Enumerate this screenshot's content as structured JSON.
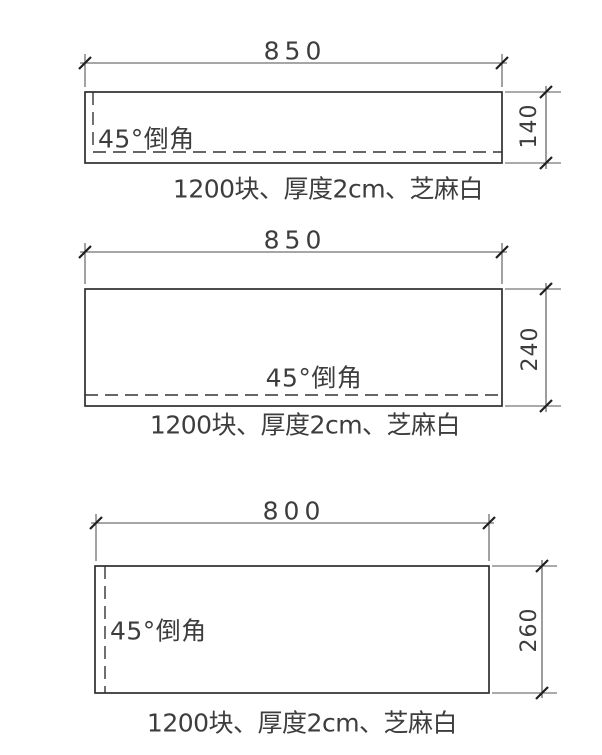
{
  "drawing": {
    "background_color": "#ffffff",
    "object_line_color": "#2e2e2e",
    "dimension_line_color": "#4d4d4d",
    "text_color": "#3d3d3d",
    "panels": [
      {
        "width_label": "850",
        "height_label": "140",
        "chamfer_label": "45°倒角",
        "chamfer_sides": "left-and-bottom",
        "caption": "1200块、厚度2cm、芝麻白"
      },
      {
        "width_label": "850",
        "height_label": "240",
        "chamfer_label": "45°倒角",
        "chamfer_sides": "bottom",
        "caption": "1200块、厚度2cm、芝麻白"
      },
      {
        "width_label": "800",
        "height_label": "260",
        "chamfer_label": "45°倒角",
        "chamfer_sides": "left",
        "caption": "1200块、厚度2cm、芝麻白"
      }
    ]
  }
}
